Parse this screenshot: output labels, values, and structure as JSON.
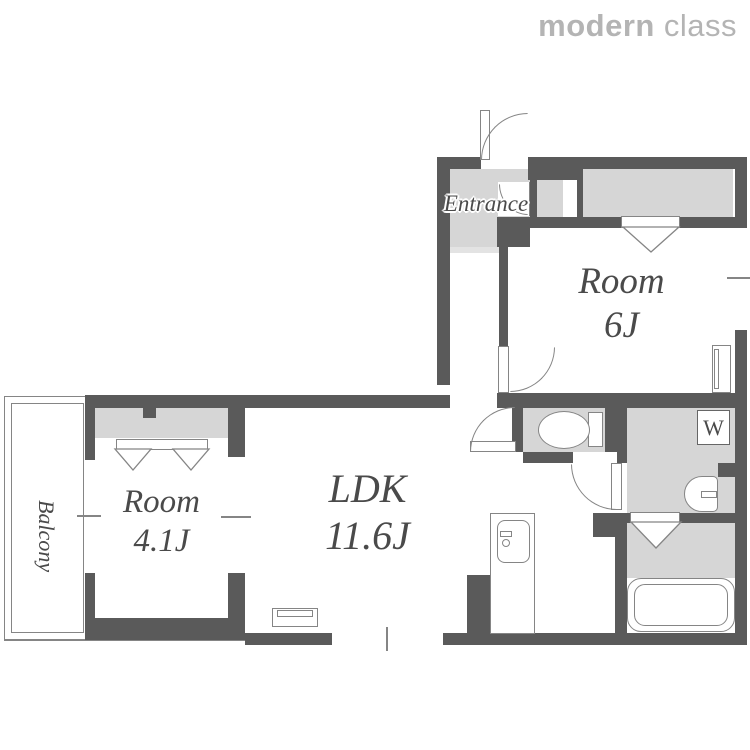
{
  "logo": {
    "part_bold": "modern",
    "part_light": "class"
  },
  "labels": {
    "entrance": "Entrance",
    "room6_name": "Room",
    "room6_size": "6J",
    "room41_name": "Room",
    "room41_size": "4.1J",
    "ldk_name": "LDK",
    "ldk_size": "11.6J",
    "balcony": "Balcony",
    "washer": "W"
  },
  "colors": {
    "wall": "#5a5a5a",
    "floor": "#d6d6d6",
    "step": "#e3e3e3",
    "line": "#858585",
    "text": "#4a4a4a",
    "logo": "#b4b4b4"
  }
}
